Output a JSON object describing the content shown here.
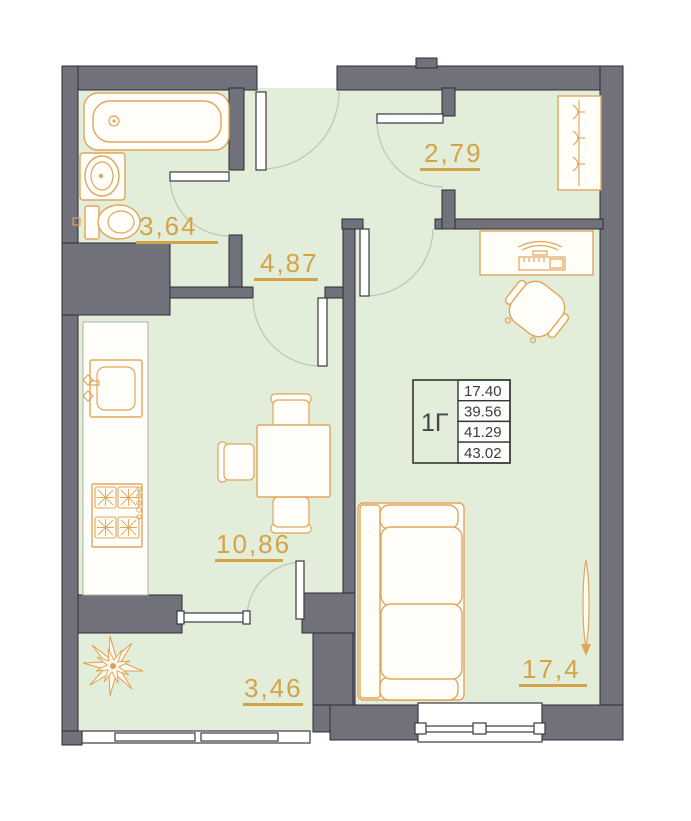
{
  "plan": {
    "title": "apartment-floor-plan",
    "rooms": {
      "bathroom": {
        "area": "3,64"
      },
      "hallway": {
        "area": "4,87"
      },
      "dressing": {
        "area": "2,79"
      },
      "kitchen": {
        "area": "10,86"
      },
      "balcony": {
        "area": "3,46"
      },
      "living": {
        "area": "17,4"
      }
    },
    "info_table": {
      "unit": "1Г",
      "rows": [
        "17.40",
        "39.56",
        "41.29",
        "43.02"
      ]
    },
    "colors": {
      "wall": "#71717b",
      "floor": "#e2edda",
      "furniture_outline": "#e0a55c",
      "label": "#d4a348",
      "line": "#3a3a3f"
    }
  }
}
